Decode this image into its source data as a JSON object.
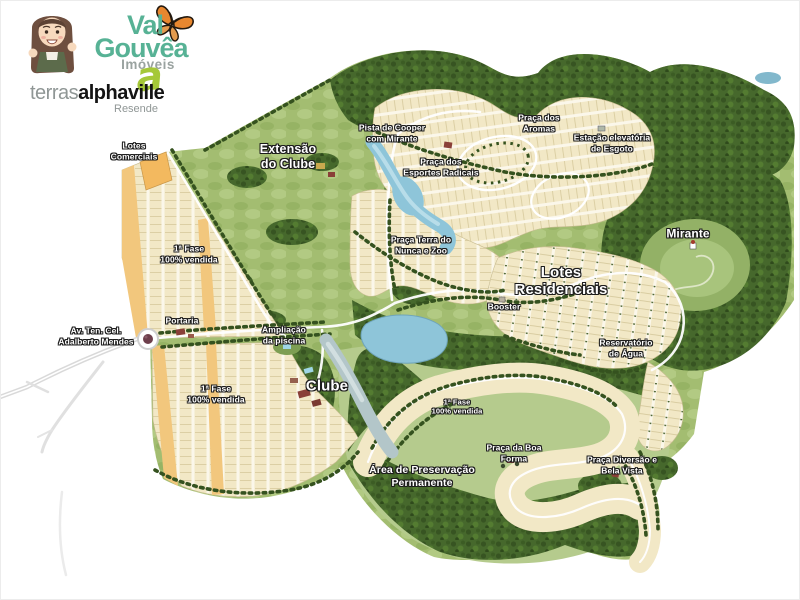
{
  "branding": {
    "agency_name_line1": "Val",
    "agency_name_line2": "Gouvêa",
    "agency_tagline": "Imóveis",
    "alphaville_a": "a",
    "developer_prefix": "terras",
    "developer_name": "alphaville",
    "project_city": "Resende"
  },
  "palette": {
    "agency_green": "#57b295",
    "alphaville_green": "#a5c838",
    "forest_green": "#44632b",
    "parkland_green": "#aec679",
    "lot_beige": "#f2e8c6",
    "commercial_orange": "#f2b95f",
    "water_blue": "#8ec5d9",
    "label_text": "#ffffff"
  },
  "map_labels": {
    "lotes_comerciais": "Lotes\nComerciais",
    "extensao_clube": "Extensão\ndo Clube",
    "pista_cooper": "Pista de Cooper\ncom Mirante",
    "praca_aromas": "Praça dos\nAromas",
    "estacao_esgoto": "Estação elevatória\nde Esgoto",
    "praca_esportes": "Praça dos\nEsportes Radicais",
    "praca_terra": "Praça Terra do\nNunca e Zoo",
    "mirante": "Mirante",
    "fase1_a": "1ª Fase\n100% vendida",
    "lotes_residenciais": "Lotes\nResidenciais",
    "booster": "Booster",
    "av_adalberto": "Av. Ten. Cel.\nAdalberto Mendes",
    "portaria": "Portaria",
    "ampliacao_piscina": "Ampliação\nda piscina",
    "fase1_b": "1ª Fase\n100% vendida",
    "clube": "Clube",
    "fase1_c": "1ª Fase\n100% vendida",
    "praca_boa_forma": "Praça da Boa\nForma",
    "area_preservacao": "Área de Preservação\nPermanente",
    "reservatorio": "Reservatório\nde Água",
    "praca_diversao": "Praça Diversão e\nBela Vista"
  }
}
